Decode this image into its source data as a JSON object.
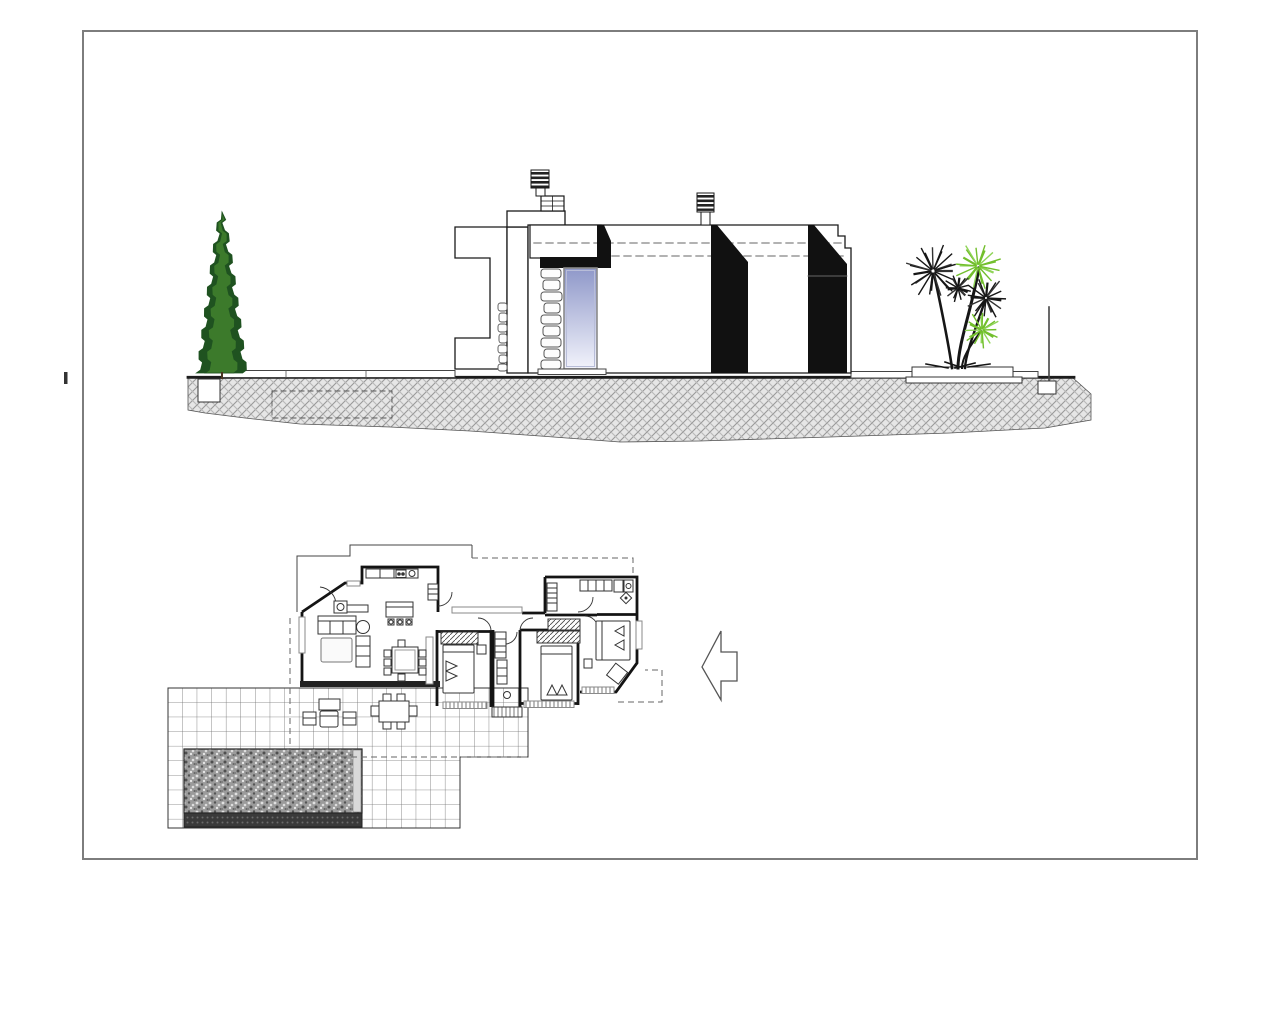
{
  "document": {
    "kind": "architectural-drawing",
    "views": {
      "top_view": "house-side-elevation",
      "bottom_view": "house-floor-plan-with-pool-terrace"
    }
  },
  "colors": {
    "ink": "#1a1a1a",
    "frame": "#7d7d7d",
    "gray_line": "#8a8a8a",
    "dash": "#666666",
    "ground_fill": "#e6e6e6",
    "ground_hatch": "#9a9a9a",
    "window_top": "#8f98c9",
    "window_bottom": "#f2f3fb",
    "tree_dark": "#1f5220",
    "tree_light": "#3c7a2b",
    "palm_green": "#72bf2c",
    "palm_green_light": "#8fd457",
    "palm_black": "#161616",
    "pool_base": "#9b9b9b",
    "pool_dark": "#3a3a3a"
  },
  "elevation": {
    "chimney_count": 2,
    "black_towers": 2,
    "dashed_roof_lines": 2,
    "cypress": {
      "cx": 222,
      "top": 212,
      "bottom": 373,
      "half_width": 23,
      "steps": 15
    },
    "palms": {
      "crowns": [
        {
          "cx": 933,
          "cy": 271,
          "r": 26,
          "color": "black",
          "spikes": 22
        },
        {
          "cx": 978,
          "cy": 266,
          "r": 22,
          "color": "green",
          "spikes": 20
        },
        {
          "cx": 958,
          "cy": 288,
          "r": 13,
          "color": "black",
          "spikes": 16
        },
        {
          "cx": 986,
          "cy": 298,
          "r": 20,
          "color": "black",
          "spikes": 18
        },
        {
          "cx": 982,
          "cy": 330,
          "r": 17,
          "color": "green",
          "spikes": 18
        }
      ]
    }
  },
  "floor_plan": {
    "bedrooms": 3,
    "beds": 3,
    "wardrobes": 3,
    "sofas": 2,
    "dining_chairs": 8,
    "island_stools": 3,
    "outdoor_dining_chairs": 6,
    "pool": {
      "present": true
    },
    "terrace": {
      "tiled": true
    },
    "direction_arrow": {
      "direction": "left"
    }
  }
}
